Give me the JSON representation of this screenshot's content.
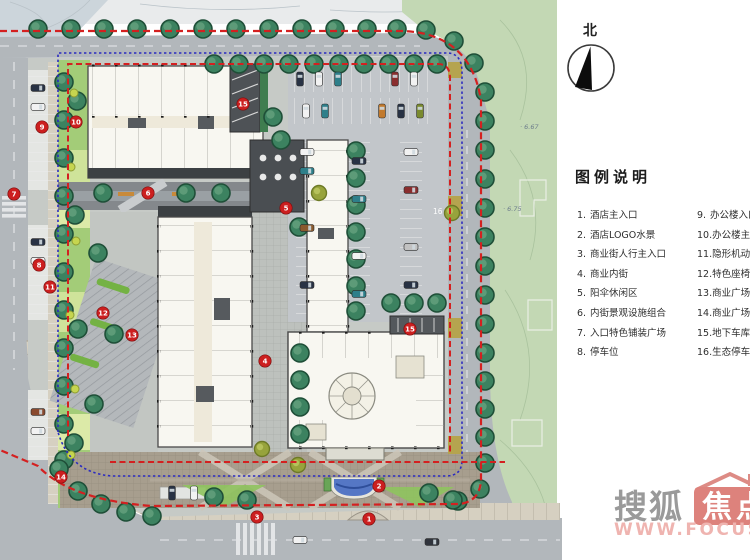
{
  "legend": {
    "title": "图例说明",
    "left": [
      {
        "num": "1.",
        "label": "酒店主入口"
      },
      {
        "num": "2.",
        "label": "酒店LOGO水景"
      },
      {
        "num": "3.",
        "label": "商业街人行主入口"
      },
      {
        "num": "4.",
        "label": "商业内街"
      },
      {
        "num": "5.",
        "label": "阳伞休闲区"
      },
      {
        "num": "6.",
        "label": "内街景观设施组合"
      },
      {
        "num": "7.",
        "label": "入口特色铺装广场"
      },
      {
        "num": "8.",
        "label": "停车位"
      }
    ],
    "right": [
      {
        "num": "9.",
        "label": "办公楼入口"
      },
      {
        "num": "10.",
        "label": "办公楼主"
      },
      {
        "num": "11.",
        "label": "隐形机动"
      },
      {
        "num": "12.",
        "label": "特色座椅"
      },
      {
        "num": "13.",
        "label": "商业广场"
      },
      {
        "num": "14.",
        "label": "商业广场"
      },
      {
        "num": "15.",
        "label": "地下车库"
      },
      {
        "num": "16.",
        "label": "生态停车"
      }
    ]
  },
  "north": {
    "label": "北"
  },
  "plan": {
    "markers": [
      {
        "n": "1"
      },
      {
        "n": "2"
      },
      {
        "n": "3"
      },
      {
        "n": "4"
      },
      {
        "n": "5"
      },
      {
        "n": "6"
      },
      {
        "n": "7"
      },
      {
        "n": "8"
      },
      {
        "n": "9"
      },
      {
        "n": "10"
      },
      {
        "n": "11"
      },
      {
        "n": "12"
      },
      {
        "n": "13"
      },
      {
        "n": "14"
      },
      {
        "n": "15"
      },
      {
        "n": "15"
      }
    ],
    "parking_label": "16",
    "elevations": [
      {
        "v": "6.67"
      },
      {
        "v": "6.75"
      }
    ]
  },
  "watermark": {
    "sohu": "搜狐",
    "focus": "焦点",
    "url": "WWW.FOCUS"
  }
}
